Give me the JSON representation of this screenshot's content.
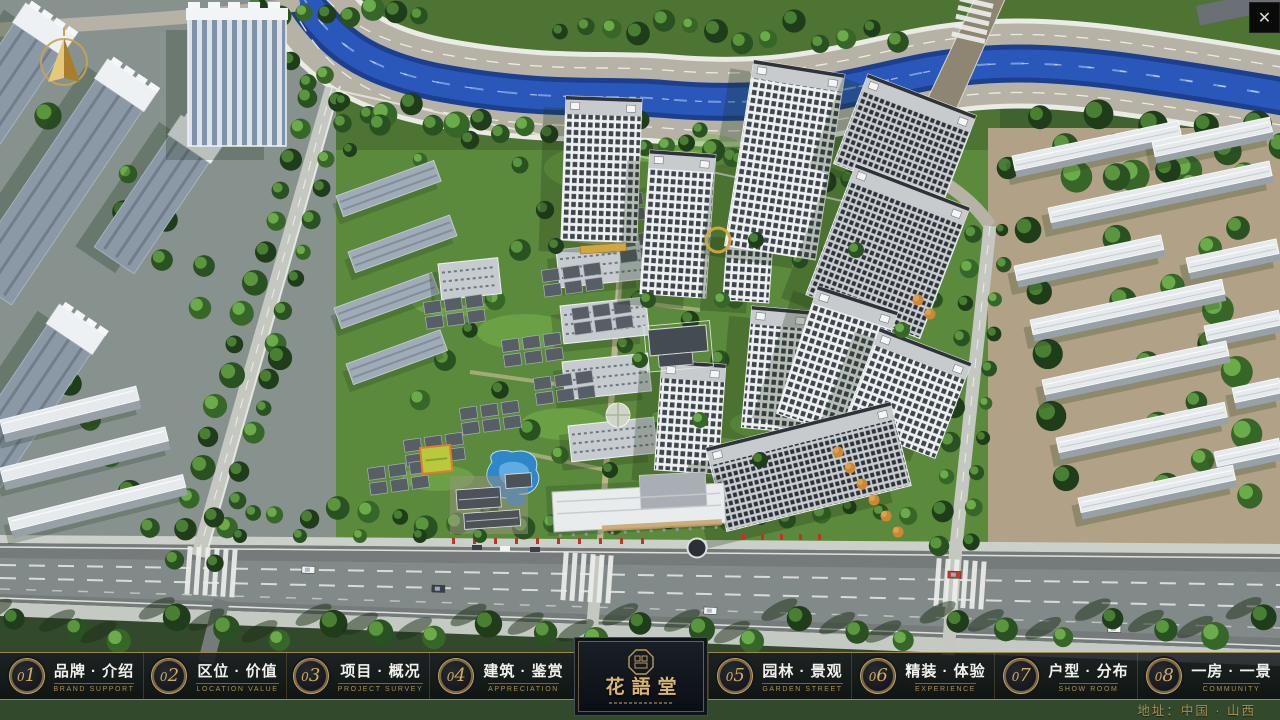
{
  "window": {
    "close_glyph": "✕"
  },
  "nav": {
    "items": [
      {
        "num": "01",
        "zh": "品牌 · 介绍",
        "en": "BRAND SUPPORT"
      },
      {
        "num": "02",
        "zh": "区位 · 价值",
        "en": "LOCATION VALUE"
      },
      {
        "num": "03",
        "zh": "项目 · 概况",
        "en": "PROJECT SURVEY"
      },
      {
        "num": "04",
        "zh": "建筑 · 鉴赏",
        "en": "APPRECIATION"
      },
      {
        "num": "05",
        "zh": "园林 · 景观",
        "en": "GARDEN STREET"
      },
      {
        "num": "06",
        "zh": "精装 · 体验",
        "en": "EXPERIENCE"
      },
      {
        "num": "07",
        "zh": "户型 · 分布",
        "en": "SHOW ROOM"
      },
      {
        "num": "08",
        "zh": "一房 · 一景",
        "en": "COMMUNITY"
      }
    ]
  },
  "logo": {
    "name_zh": "花語堂"
  },
  "footer": {
    "address": "地址：中国 · 山西"
  },
  "colors": {
    "gold": "#c9a45f",
    "bar_bg": "#10151b",
    "river": "#2b58bd"
  }
}
